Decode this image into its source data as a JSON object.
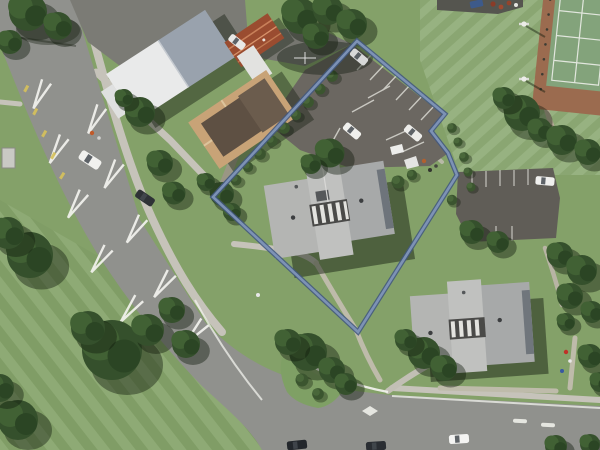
{
  "map": {
    "kind": "aerial-imagery-with-parcel-overlay",
    "description": "Aerial photograph of a suburban block; a steel-blue outline highlights one parcel containing a parking area and a large H-shaped building",
    "boundary": {
      "points": "357,41 445,114 431,131 448,153 457,175 358,332 213,197",
      "stroke_outer": "#42587e",
      "stroke_inner": "#8095b8"
    },
    "colors": {
      "grass": "#84a169",
      "field": "#8fac77",
      "park": "#87a56c",
      "road": "#90918d",
      "path": "#c6c3ba",
      "parking": "#6b6761",
      "parking_dark": "#605d57",
      "marking": "#f4f4ef",
      "yellow_line": "#d8c35a",
      "roof_white": "#e9eaea",
      "roof_slate": "#99a2ad",
      "roof_gray": "#c0c1bf",
      "roof_gray_mid": "#b4b5b3",
      "roof_gray_dark": "#a7a9a9",
      "roof_tan": "#c8a377",
      "roof_brown": "#5e5043",
      "roof_rust": "#9a4c30",
      "court_green": "#83a37b",
      "court_brown": "#9b6b4f",
      "tree": "#35502c",
      "shadow": "rgba(24,34,20,0.5)"
    },
    "features": [
      "main road with white chevron markings",
      "white-roofed building",
      "rust corrugated shed roof",
      "tan hip-roof house",
      "parcel parking lot with marked stalls and parked cars",
      "hedge row along parcel edge",
      "large gray H-shaped building with colonnade",
      "second gray H-shaped building",
      "second parking lot with white car",
      "tennis courts",
      "sports field with floodlight poles",
      "park lawn with mature trees",
      "traffic island with shrubs",
      "bottom road with lane markings and cars",
      "footpaths and bus shelter",
      "property boundary overlay"
    ]
  }
}
